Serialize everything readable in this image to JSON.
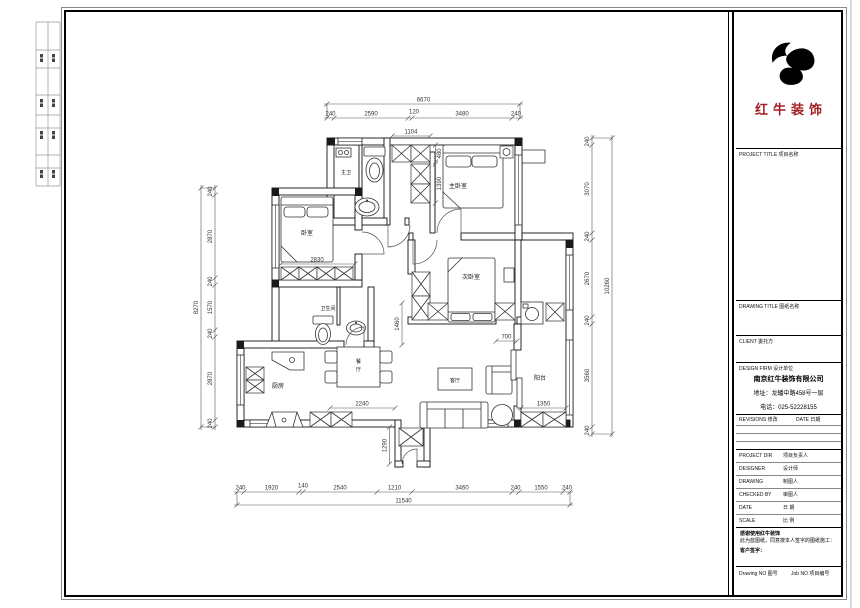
{
  "title_block": {
    "logo_text": "红牛装饰",
    "project_title_label": "PROJECT TITLE 项目名称",
    "drawing_title_label": "DRAWING TITLE 图纸名称",
    "client_label": "CLIENT 委托方",
    "design_firm_label": "DESIGN FIRM 设计单位",
    "company_name": "南京红牛装饰有限公司",
    "company_address": "地址：龙蟠中路458号一层",
    "company_phone": "电话：025-52228155",
    "revisions_label": "REVISIONS 修改",
    "date_col_label": "DATE 日期",
    "project_dir_en": "PROJECT DIR",
    "project_dir_zh": "项目负责人",
    "designer_en": "DESIGNER",
    "designer_zh": "设计师",
    "drawing_en": "DRAWING",
    "drawing_zh": "制图人",
    "checked_en": "CHECKED BY",
    "checked_zh": "审图人",
    "date_en": "DATE",
    "date_zh": "日 期",
    "scale_en": "SCALE",
    "scale_zh": "比 例",
    "note_line1": "感谢使用红牛装饰",
    "note_line2": "此为蓝图纸，同意按本人签字的图纸施工：",
    "client_sign_label": "客户签字：",
    "drawing_no_label": "Drawing NO 图号",
    "job_no_label": "Job NO 项目编号"
  },
  "plan": {
    "rooms": {
      "master_bath": "主卫",
      "master_bedroom": "主卧室",
      "bedroom": "卧室",
      "second_bedroom": "次卧室",
      "bathroom": "卫生间",
      "kitchen": "厨房",
      "dining": "餐厅",
      "living": "客厅",
      "balcony": "阳台"
    },
    "dims": {
      "top": {
        "total": "6670",
        "segs": [
          "240",
          "2590",
          "120",
          "3480",
          "240"
        ]
      },
      "bottom": {
        "total": "11540",
        "segs": [
          "240",
          "1920",
          "140",
          "2540",
          "1210",
          "3460",
          "240",
          "1550",
          "240"
        ]
      },
      "left": {
        "total": "8270",
        "segs": [
          "240",
          "2870",
          "240",
          "1570",
          "240",
          "2870",
          "240"
        ]
      },
      "right": {
        "total": "10260",
        "segs": [
          "240",
          "3070",
          "240",
          "2670",
          "240",
          "3560",
          "240"
        ]
      },
      "inner": {
        "closet_w": "1104",
        "closet_d": "480",
        "closet_h": "1390",
        "bed_w": "2830",
        "hall": "1460",
        "dining_w": "2240",
        "gap": "700",
        "balcony_w": "1350",
        "entry_d": "1290"
      }
    }
  },
  "colors": {
    "accent_red": "#a31f24",
    "wall": "#1a1a1a",
    "dim": "#555555"
  }
}
